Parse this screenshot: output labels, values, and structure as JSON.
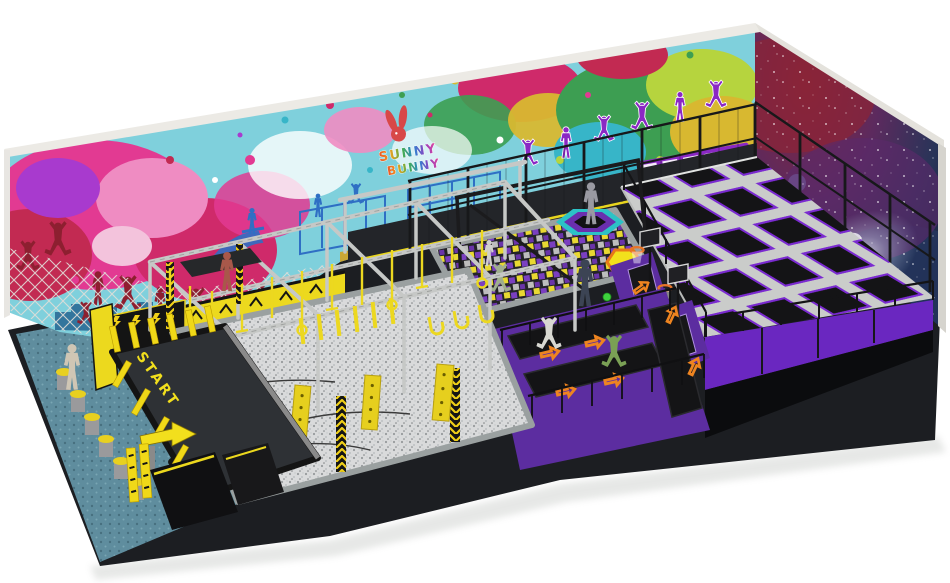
{
  "scene": {
    "description": "3D architectural render of an indoor trampoline park attraction on a white background",
    "brand": {
      "logo_line1": "SUNNY",
      "logo_line2": "BUNNY"
    },
    "labels": {
      "start": "START"
    },
    "people_count": 9,
    "palette": {
      "floor_teal": "#5f8d9e",
      "equipment_yellow": "#f0d818",
      "equipment_purple": "#5c2da0",
      "trampoline_trim_purple": "#7a2ad0",
      "mat_black": "#141416",
      "frame_gray": "#c9cbc9",
      "accent_orange": "#ee8420",
      "wall_light_blue": "#7fd0dc",
      "wall_magenta": "#e23a92",
      "wall_green": "#3d9e52",
      "galaxy_red": "#8a2438",
      "galaxy_blue": "#24365e",
      "silhouette_red": "#8d1f30",
      "silhouette_purple": "#8a28c4"
    },
    "zones": [
      {
        "name": "splatter-mural-wall",
        "note": "paint-splatter mural with jumping silhouettes, skate doodles, city skyline and train"
      },
      {
        "name": "climbing-net",
        "note": "light rope net over left mural"
      },
      {
        "name": "galaxy-mural-wall",
        "note": "nebula and spiral galaxy mural on right wall"
      },
      {
        "name": "safety-net-fence",
        "note": "black framed netting in front of walls"
      },
      {
        "name": "ninja-obstacle-course",
        "note": "steel truss frame with yellow hanging obstacles over gray ball pit with tires"
      },
      {
        "name": "foam-cube-pit",
        "note": "pit filled with purple, yellow and gray foam cubes"
      },
      {
        "name": "trampoline-grid",
        "note": "field of square trampolines, gray pads, purple trim, black mats"
      },
      {
        "name": "basketball-dunk-lanes",
        "note": "two hoops with orange rims over purple wedges"
      },
      {
        "name": "tumble-tracks",
        "note": "black trampoline lanes with orange jump arrows"
      },
      {
        "name": "hexagon-trampolines",
        "note": "teal-rim and orange-rim hexagonal trampolines"
      },
      {
        "name": "start-platform",
        "note": "black platform with yellow START floor text"
      },
      {
        "name": "stepping-pods",
        "note": "gray cylinders with yellow tops"
      },
      {
        "name": "teal-carpet-floor",
        "note": "dotted teal carpet"
      },
      {
        "name": "arrow-sign",
        "note": "yellow directional arrow at course entry"
      }
    ]
  }
}
